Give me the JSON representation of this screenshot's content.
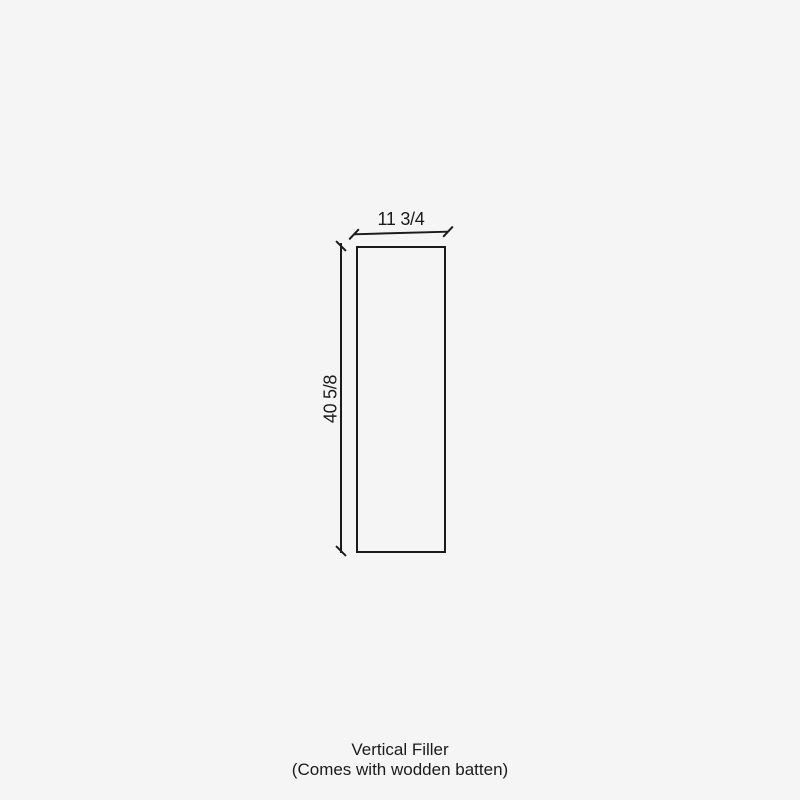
{
  "theme": {
    "background": "#f5f5f6",
    "line_color": "#1b1b1b",
    "text_color": "#1b1b1b"
  },
  "diagram": {
    "width_label": "11 3/4",
    "height_label": "40 5/8"
  },
  "caption": {
    "line1": "Vertical Filler",
    "line2": "(Comes with wodden batten)"
  }
}
